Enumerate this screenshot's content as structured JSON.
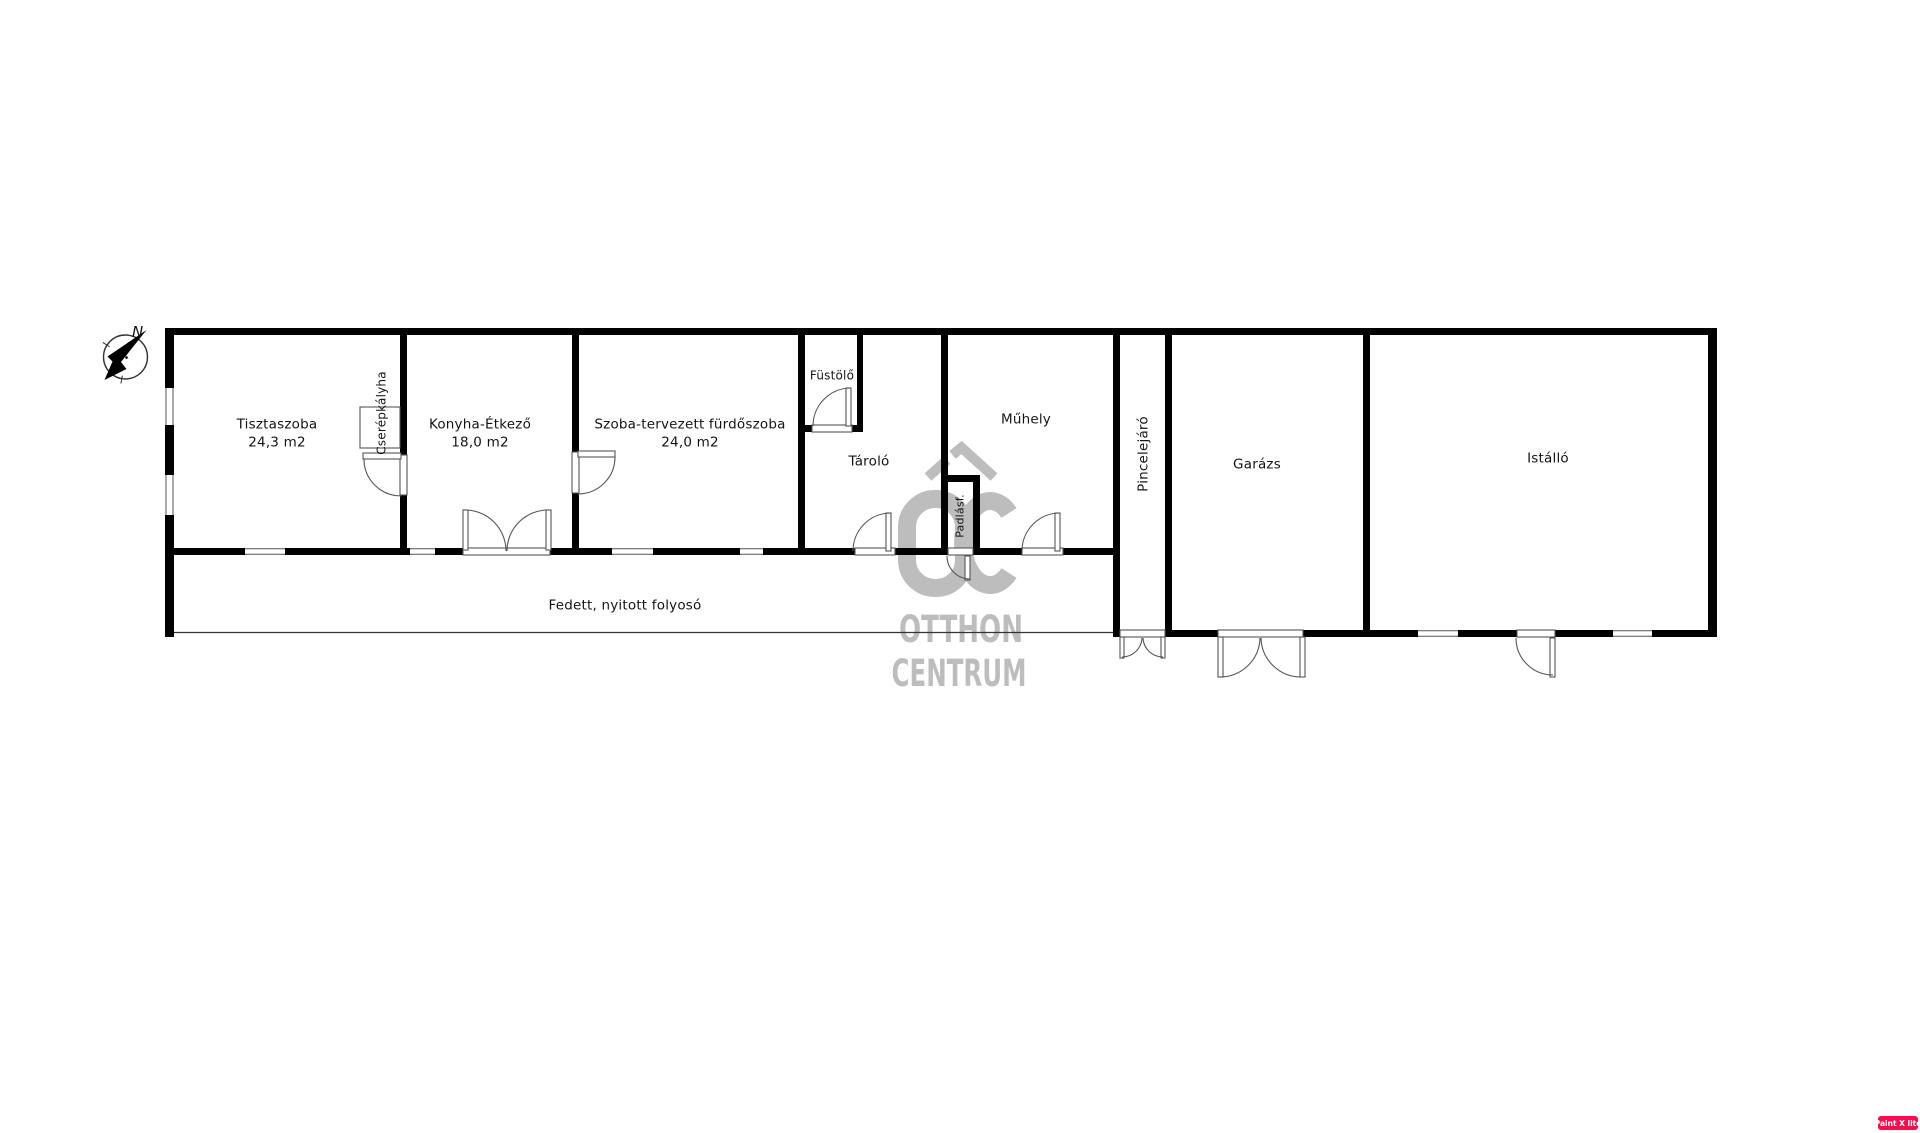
{
  "rooms": [
    {
      "id": "tisztaszoba",
      "name": "Tisztaszoba",
      "area": "24,3 m2"
    },
    {
      "id": "konyha-etkezo",
      "name": "Konyha-Étkező",
      "area": "18,0 m2"
    },
    {
      "id": "szoba-furdoszoba",
      "name": "Szoba-tervezett fürdőszoba",
      "area": "24,0 m2"
    },
    {
      "id": "fustolo",
      "name": "Füstölő"
    },
    {
      "id": "tarolo",
      "name": "Tároló"
    },
    {
      "id": "padlasfeljaro",
      "name": "Padlásf."
    },
    {
      "id": "muhely",
      "name": "Műhely"
    },
    {
      "id": "pincelejaro",
      "name": "Pincelejáró"
    },
    {
      "id": "garazs",
      "name": "Garázs"
    },
    {
      "id": "istallo",
      "name": "Istálló"
    }
  ],
  "corridor": {
    "label": "Fedett, nyitott folyosó"
  },
  "fixtures": {
    "tile_stove_label": "Cserépkályha"
  },
  "compass": {
    "north_label": "N"
  },
  "watermark": {
    "brand_line1": "OTTHON",
    "brand_line2": "CENTRUM"
  },
  "badge": {
    "label": "Paint X lite"
  },
  "colors": {
    "background": "#ffffff",
    "wall": "#000000",
    "thin_line": "#444444",
    "watermark_gray": "#bdbdbd",
    "badge_bg": "#fa0c50",
    "badge_text": "#ffffff"
  }
}
